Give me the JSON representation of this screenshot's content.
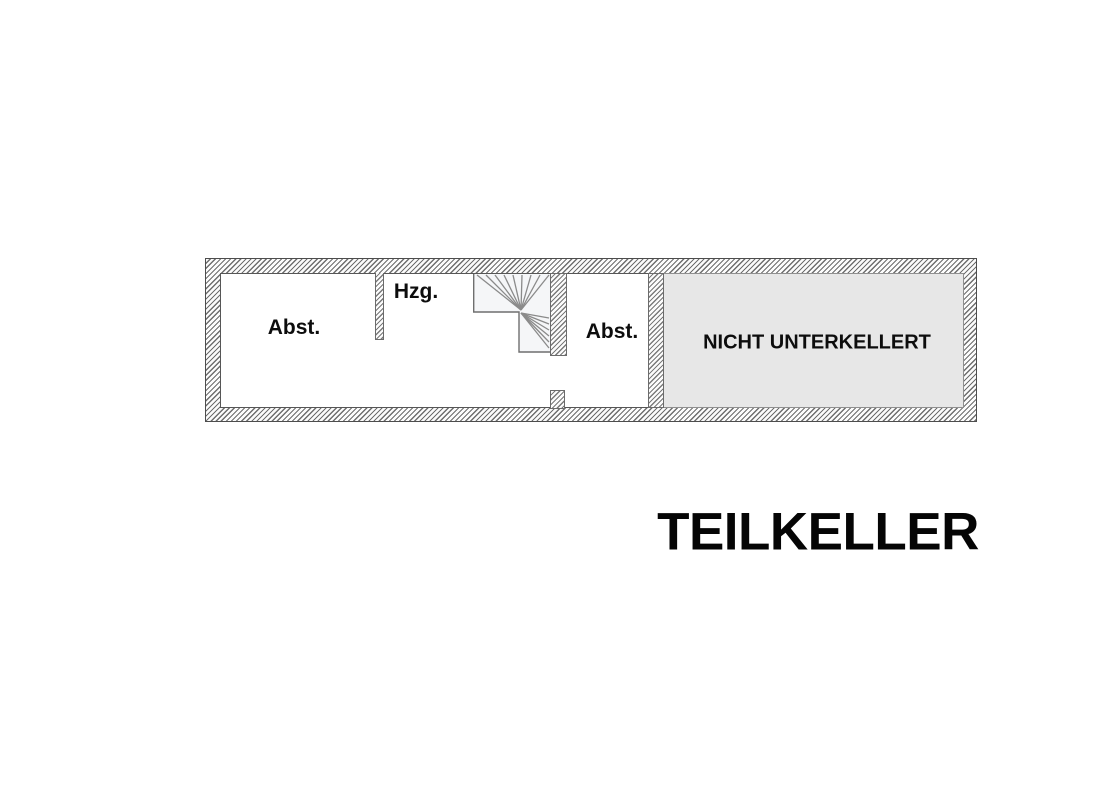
{
  "floorplan": {
    "title": "TEILKELLER",
    "areas": {
      "abst_left": {
        "label": "Abst."
      },
      "hzg": {
        "label": "Hzg."
      },
      "abst_right": {
        "label": "Abst."
      },
      "nicht_unterkellert": {
        "label": "NICHT UNTERKELLERT"
      }
    },
    "icons": {
      "staircase": "winder-staircase-icon"
    },
    "colors": {
      "wall_hatch_line": "#6e6e6e",
      "no_basement_fill": "#e7e7e7",
      "stair_fill": "#f5f6f8",
      "text": "#0d0d0d"
    }
  }
}
